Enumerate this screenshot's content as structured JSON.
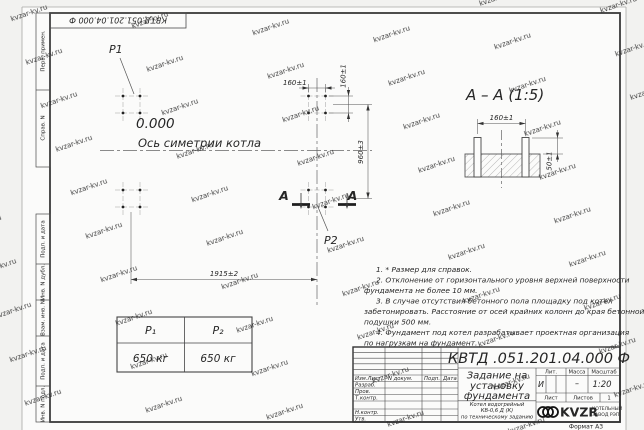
{
  "watermark": {
    "text": "kvzar-kv.ru"
  },
  "frame": {
    "top_stamp": "КВТД.051.201.04.000 Ф",
    "format_label": "Формат А3",
    "margin_labels": {
      "perv_primen": "Перв. примен.",
      "sprav_n": "Справ. N",
      "podp_data_top": "Подп. и дата",
      "inv_n_dubl": "Инв. N дубл.",
      "vzam_inv_n": "Взам. инв. N",
      "podp_data_bottom": "Подп. и дата",
      "inv_n_podl": "Инв. N подл."
    }
  },
  "plan": {
    "p1": "P1",
    "p2": "P2",
    "elevation": "0.000",
    "axis_label": "Ось симетрии котла",
    "dim_width_top": "160±1",
    "dim_height_side": "160±1",
    "dim_960": "960±3",
    "dim_1915": "1915±2",
    "section_letter": "А"
  },
  "section_view": {
    "title": "А – А (1:5)",
    "dim_160": "160±1",
    "dim_50": "50±1"
  },
  "notes": {
    "lines": [
      "1. * Размер для справок.",
      "2. Отклонение от горизонтального уровня верхней поверхности",
      "фундамента не более 10 мм.",
      "3. В случае отсутствия бетонного пола площадку под котел",
      "забетонировать. Расстояние от осей крайних колонн до края бетонной",
      "подушки 500 мм.",
      "4. Фундамент под котел разрабатывает проектная организация",
      "по нагрузкам на фундамент."
    ]
  },
  "load_table": {
    "headers": [
      "P₁",
      "P₂"
    ],
    "values": [
      "650 кг",
      "650 кг"
    ]
  },
  "title_block": {
    "doc_number": "КВТД .051.201.04.000  Ф",
    "header_cols": {
      "izm_list": "Изм.Лист",
      "n_dokum": "N докум.",
      "podp": "Подп.",
      "data": "Дата"
    },
    "rows": {
      "razrab": "Разраб.",
      "prov": "Пров.",
      "t_kontr": "Т.контр.",
      "n_kontr": "Н.контр.",
      "utv": "Утв."
    },
    "title_lines": [
      "Задание на",
      "установку",
      "фундамента"
    ],
    "subtitle_lines": [
      "Котел водогрейный",
      "КВ-0,6 Д (К)",
      "по техническому заданию"
    ],
    "lit_header": "Лит.",
    "mass_header": "Масса",
    "scale_header": "Масштаб",
    "lit_value": "И",
    "mass_value": "–",
    "scale_value": "1:20",
    "list_label": "Лист",
    "listov_label": "Листов",
    "listov_value": "1",
    "logo_text": "KVZR",
    "logo_caption_lines": [
      "КОТЕЛЬНЫЙ",
      "ЗАВОД РЭП"
    ],
    "colors": {
      "line": "#3a3a3a",
      "paper": "#fbfbfa",
      "watermark": "#dee3ea"
    }
  }
}
